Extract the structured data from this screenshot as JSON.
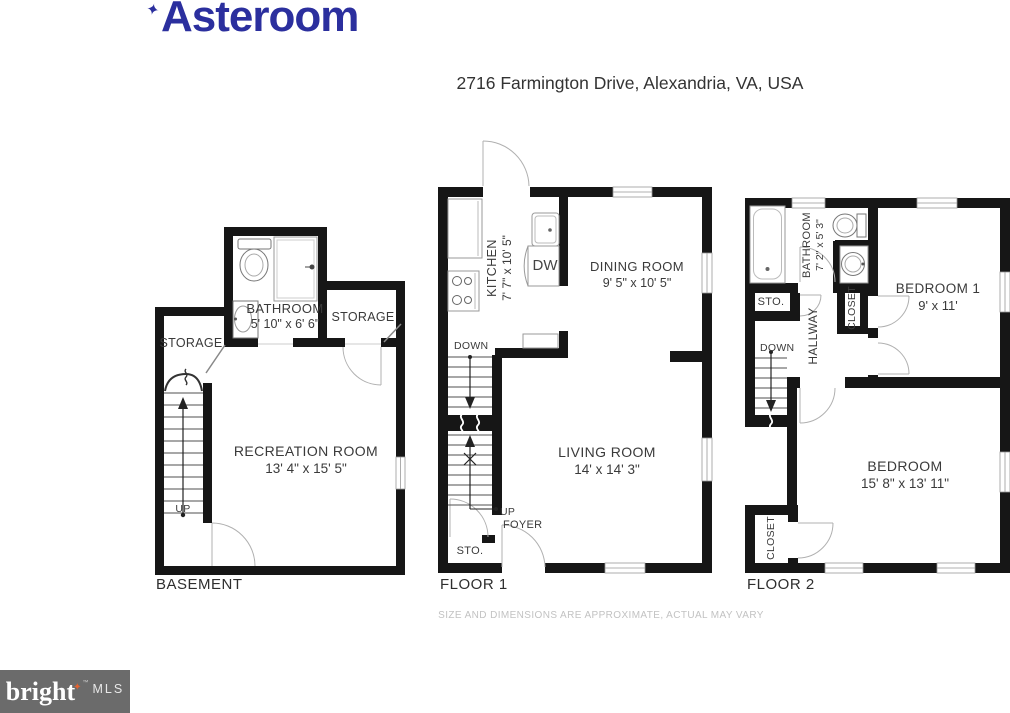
{
  "logo": {
    "brand": "Asteroom",
    "sparkle_icon": "✦",
    "color": "#2b2f9e"
  },
  "address": "2716 Farmington Drive, Alexandria, VA, USA",
  "disclaimer": "SIZE AND DIMENSIONS ARE APPROXIMATE, ACTUAL MAY VARY",
  "watermark": {
    "brand": "bright",
    "suffix": "MLS",
    "tm": "™",
    "star_icon": "✦",
    "bg_color": "#6b6b6b",
    "accent_color": "#e2612f"
  },
  "colors": {
    "wall": "#161616",
    "stair_line": "#4f4f4f",
    "door_arc": "#b0b0b0",
    "fixture": "#8f8f8f",
    "label": "#3a3a3a"
  },
  "floors": {
    "basement": {
      "label": "BASEMENT",
      "recreation_name": "RECREATION ROOM",
      "recreation_dims": "13' 4\" x 15' 5\"",
      "bathroom_name": "BATHROOM",
      "bathroom_dims": "5' 10\" x 6' 6\"",
      "storage_left": "STORAGE",
      "storage_right": "STORAGE",
      "up": "UP"
    },
    "floor1": {
      "label": "FLOOR 1",
      "kitchen_name": "KITCHEN",
      "kitchen_dims": "7' 7\" x 10' 5\"",
      "dining_name": "DINING ROOM",
      "dining_dims": "9' 5\" x 10' 5\"",
      "living_name": "LIVING ROOM",
      "living_dims": "14' x 14' 3\"",
      "dw": "DW",
      "down": "DOWN",
      "up": "UP",
      "foyer": "FOYER",
      "sto": "STO."
    },
    "floor2": {
      "label": "FLOOR 2",
      "bathroom_name": "BATHROOM",
      "bathroom_dims": "7' 2\" x 5' 3\"",
      "bedroom1_name": "BEDROOM 1",
      "bedroom1_dims": "9' x 11'",
      "bedroom_name": "BEDROOM",
      "bedroom_dims": "15' 8\" x 13' 11\"",
      "hallway": "HALLWAY",
      "closet_upper": "CLOSET",
      "closet_lower": "CLOSET",
      "sto": "STO.",
      "down": "DOWN"
    }
  }
}
